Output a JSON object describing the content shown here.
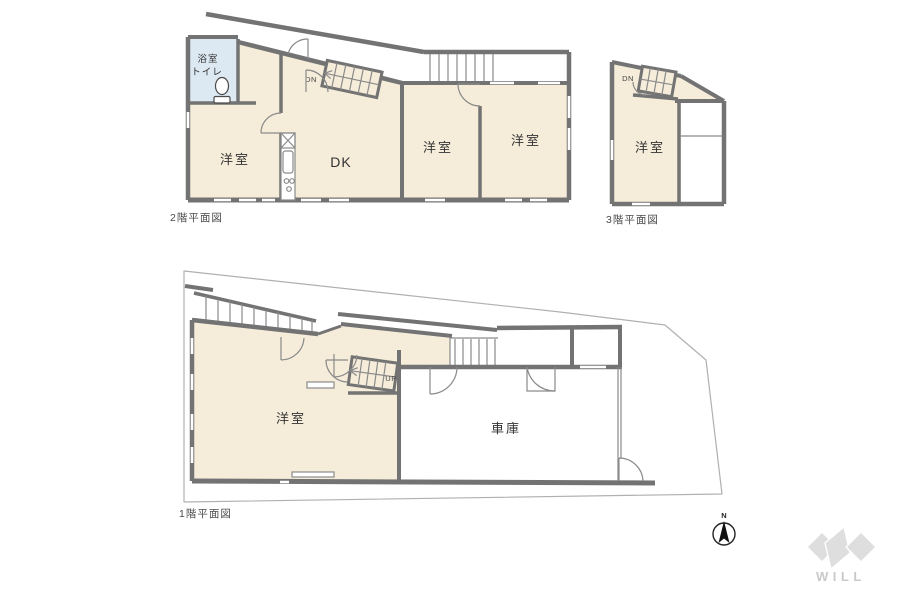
{
  "document": {
    "type": "floor-plan-sheet",
    "floors_shown": [
      "2F",
      "3F",
      "1F"
    ]
  },
  "colors": {
    "room_fill": "#f5edda",
    "bath_fill": "#dce8f2",
    "wall": "#737373",
    "thin_line": "#8a8a8a",
    "lot_line": "#b0b0b0",
    "label_text": "#333333",
    "caption_text": "#4a4a4a",
    "logo_gray": "#dedede",
    "logo_text": "#c9c9c9"
  },
  "floor2": {
    "caption": "2階平面図",
    "bath_label_line1": "浴室",
    "bath_label_line2": "トイレ",
    "room_west_left": "洋室",
    "room_dk": "DK",
    "room_west_mid": "洋室",
    "room_west_right": "洋室",
    "stair_down_label": "DN"
  },
  "floor3": {
    "caption": "3階平面図",
    "room_west": "洋室",
    "stair_down_label": "DN"
  },
  "floor1": {
    "caption": "1階平面図",
    "room_west": "洋室",
    "room_garage": "車庫",
    "stair_up_label": "UP"
  },
  "compass": {
    "north_label": "N"
  },
  "brand": {
    "logo_text": "WILL"
  }
}
